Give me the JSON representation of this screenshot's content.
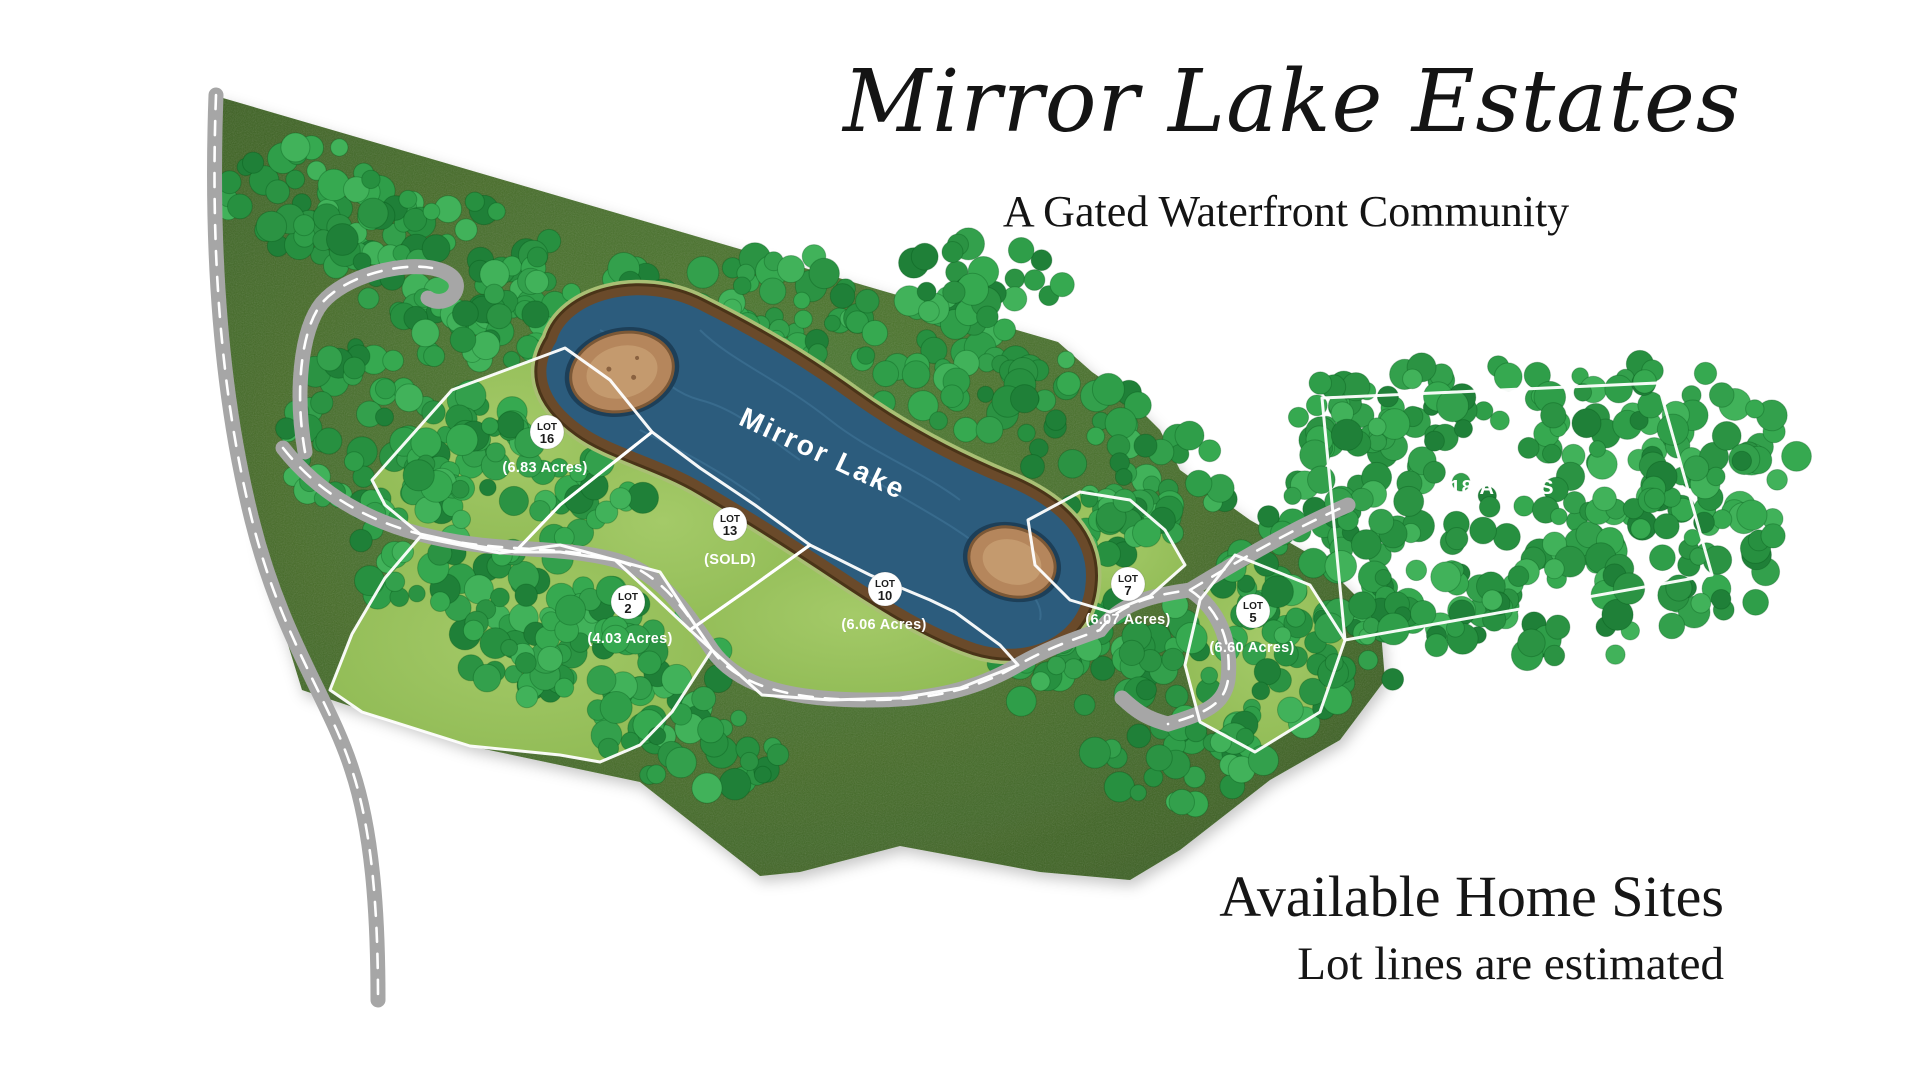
{
  "header": {
    "title": "Mirror Lake Estates",
    "subtitle": "A Gated Waterfront Community"
  },
  "map": {
    "lake": {
      "label": "Mirror Lake"
    },
    "large_parcel": {
      "label": "18 ACRES"
    },
    "lots": [
      {
        "word": "LOT",
        "number": "16",
        "detail": "(6.83 Acres)"
      },
      {
        "word": "LOT",
        "number": "13",
        "detail": "(SOLD)"
      },
      {
        "word": "LOT",
        "number": "2",
        "detail": "(4.03 Acres)"
      },
      {
        "word": "LOT",
        "number": "10",
        "detail": "(6.06 Acres)"
      },
      {
        "word": "LOT",
        "number": "7",
        "detail": "(6.07 Acres)"
      },
      {
        "word": "LOT",
        "number": "5",
        "detail": "(6.60 Acres)"
      }
    ],
    "colors": {
      "water": "#2c5c7d",
      "shore_brown": "#6a4a2a",
      "land_green": "#456c28",
      "lot_green": "#94bf5a",
      "tree_green": "#2f9e49",
      "road_gray": "#a6a6a6",
      "boundary_white": "#ffffff",
      "island_tan": "#b5865c",
      "text_black": "#141414"
    }
  },
  "footer": {
    "line1": "Available Home Sites",
    "line2": "Lot lines are estimated"
  }
}
